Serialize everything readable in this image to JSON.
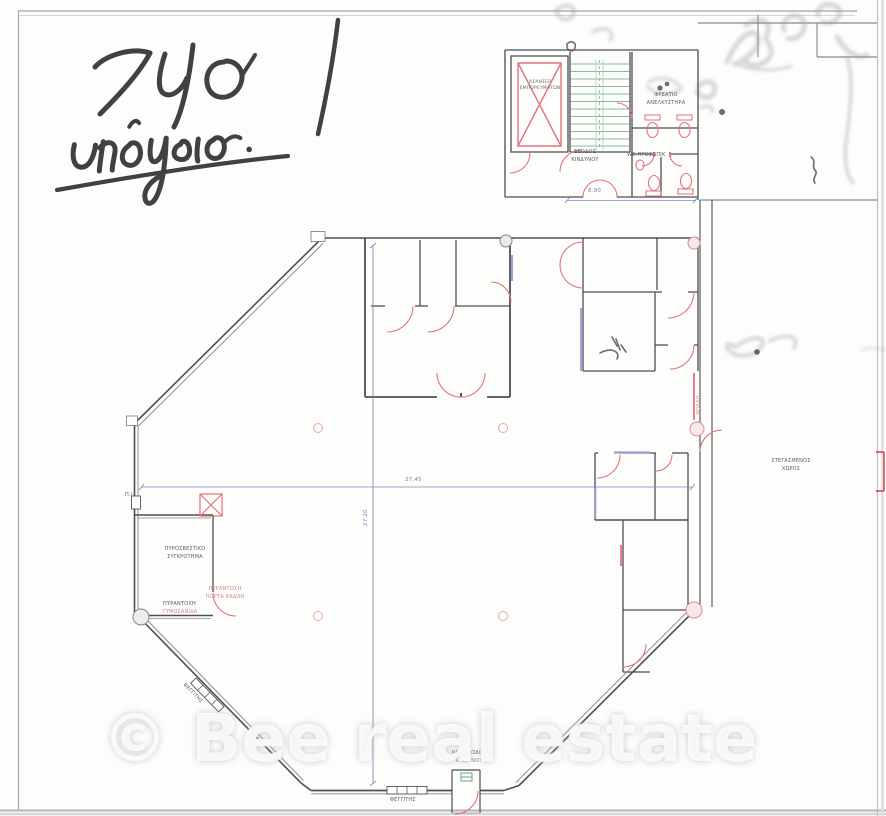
{
  "handwriting": {
    "line1": "740",
    "line2": "υπόγειο."
  },
  "watermark": {
    "text": "© Bee real estate"
  },
  "plan": {
    "dimensions": {
      "horizontal": "27.45",
      "vertical": "27.20",
      "core_width": "8.90"
    },
    "labels": {
      "freight_elevator_line1": "ΑΣΑΝΣΕΡ",
      "freight_elevator_line2": "ΕΜΠΟΡΕΥΜΑΤΩΝ",
      "elevator_shaft_line1": "ΦΡΕΑΤΙΟ",
      "elevator_shaft_line2": "ΑΝΕΛΚΥΣΤΗΡΑ",
      "emergency_exit_line1": "ΕΞΟΔΟΣ",
      "emergency_exit_line2": "ΚΙΝΔΥΝΟΥ",
      "staff_wc": "WC ΠΡΟΣΩΠΙΚ.",
      "fire_unit_line1": "ΠΥΡΟΣΒΕΣΤΙΚΟ",
      "fire_unit_line2": "ΣΥΓΚΡΟΤΗΜΑ",
      "fire_hose_point": "Π.Ι.",
      "fire_door_line1": "ΠΥΡΑΝΤΟΧΗ",
      "fire_door_line2": "ΠΟΡΤΑ ΚΑΔΩΝ",
      "fire_board_line1": "ΠΥΡΑΝΤΟΧΗ",
      "fire_board_line2": "ΓΥΨΟΣΑΝΙΔΑ",
      "covered_area_line1": "ΣΤΕΓΑΣΜΕΝΟΣ",
      "covered_area_line2": "ΧΩΡΟΣ",
      "roller_shutter": "ΡΟΛΛΟ",
      "new_exit_word1": "ΝΕΑ",
      "new_exit_word2": "ΕΞΟΔΟΣ",
      "new_exit_line2": "ΚΙΝΔΥΝΟΥ",
      "skylight_bottom": "ΦΕΓΓΙΤΗΣ",
      "skylight_diagonal": "ΦΕΓΓΙΤΗΣ"
    }
  },
  "colors": {
    "wall_grey": "#4e4e54",
    "door_arc_pink": "#e0737c",
    "stair_green": "#86bb9b",
    "dimension_blue": "#8187bb",
    "lavender_accent": "#9a9ed0",
    "handwriting_ink": "#2c2c31",
    "red_margin_mark": "#cf3d43",
    "watermark_white": "#ffffff"
  }
}
